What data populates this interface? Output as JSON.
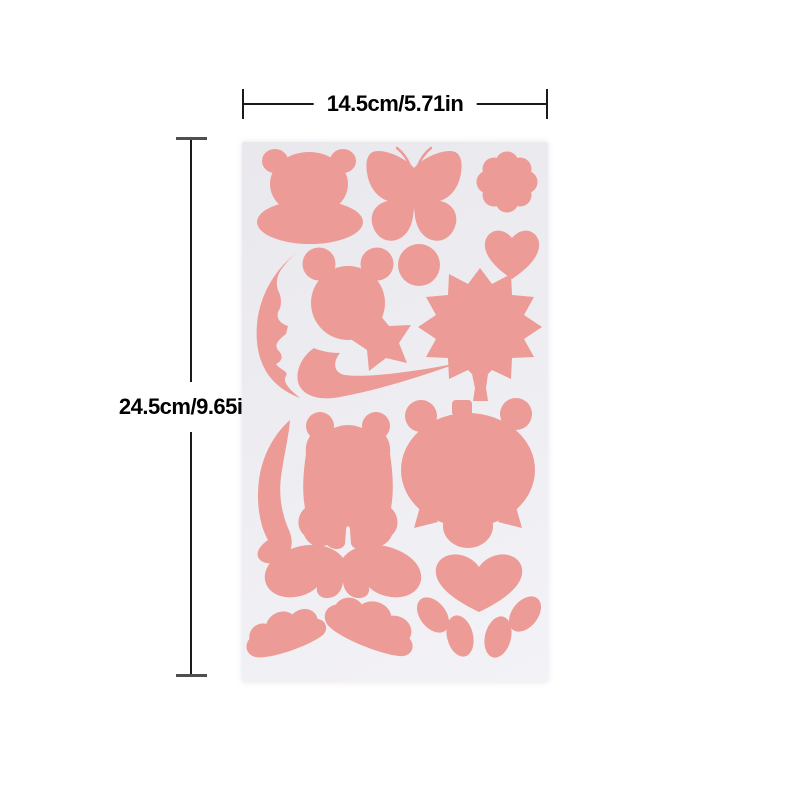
{
  "annotations": {
    "width_label": "14.5cm/5.71in",
    "height_label": "24.5cm/9.65in"
  },
  "sheet": {
    "type": "adhesive sticker sheet with die-cut pink shapes",
    "shapes": [
      "monkey-face",
      "butterfly",
      "flower",
      "heart",
      "crescent-moon-face",
      "mouse-head",
      "dot",
      "maple-leaf",
      "star",
      "swoosh",
      "curved-leaf",
      "teddy-bear",
      "owl",
      "mustache",
      "paw-pad",
      "paw-toes",
      "cloud-left",
      "cloud-right"
    ]
  },
  "theme": {
    "canvas": "#ffffff",
    "sticker": "#ec9b96",
    "sheet-top": "#e9e8ed",
    "sheet-bottom": "#f3f2f6",
    "line": "#1a1a1a",
    "tick": "#4f4f4f",
    "text": "#000000"
  }
}
